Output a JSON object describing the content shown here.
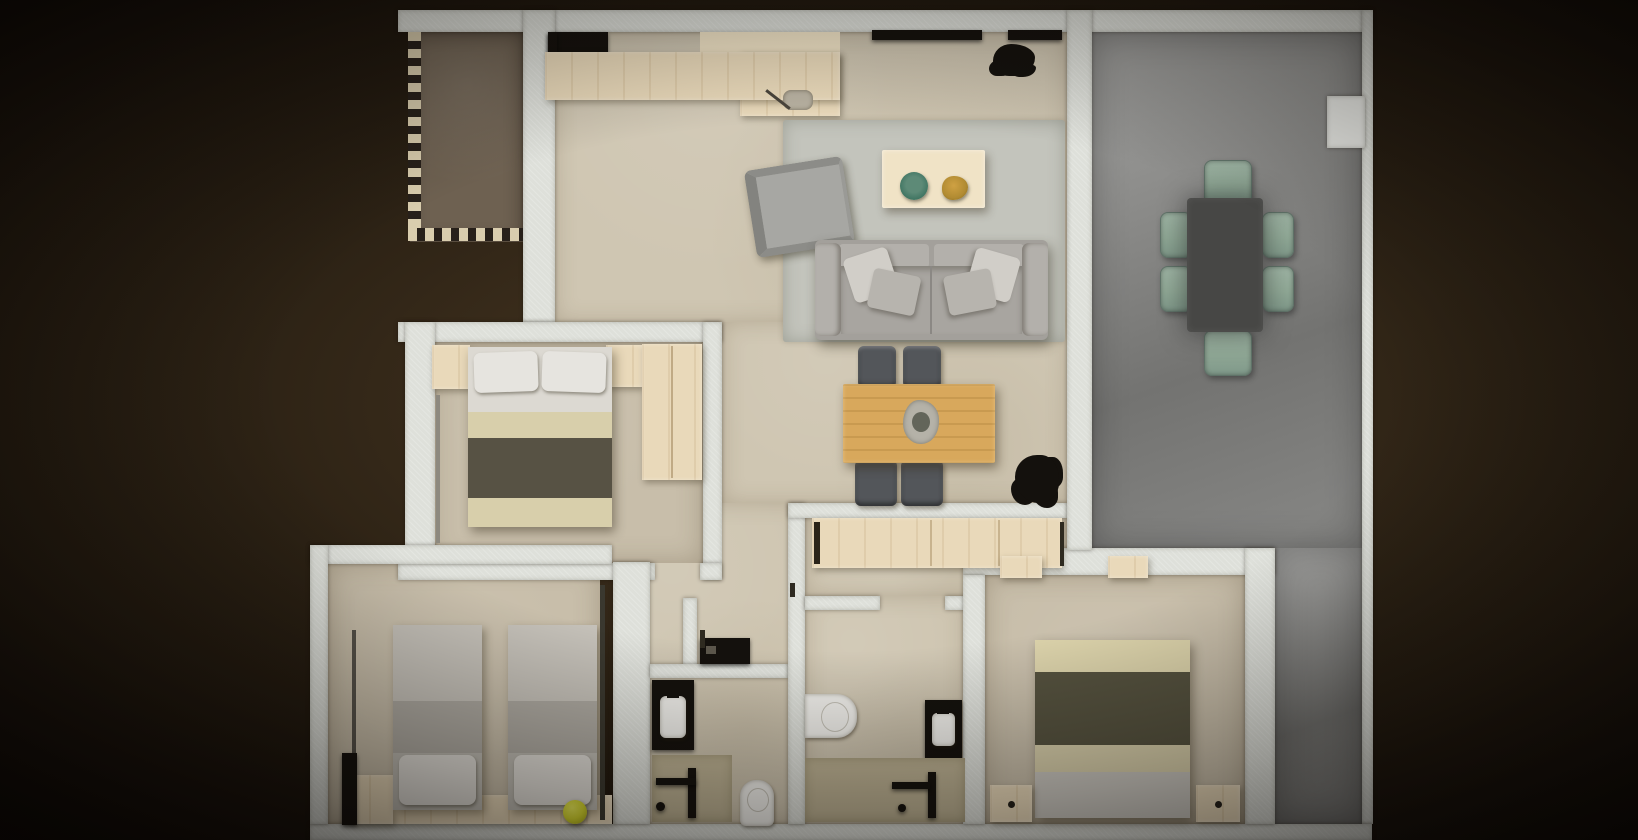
{
  "scene": {
    "type": "3d-floor-plan-render",
    "description": "Top-down 3D architectural render of an apartment floor plan, centered on a dark brown vignetted backdrop. No text labels are present in the image.",
    "rooms": [
      {
        "name": "balcony",
        "position": "top-left",
        "features": [
          "taupe-tile-floor",
          "dashed-railing-left",
          "dashed-railing-bottom"
        ]
      },
      {
        "name": "kitchen-living-room",
        "position": "top-center",
        "features": [
          "kitchen-counter",
          "black-cooktop",
          "window-slits",
          "area-rug",
          "armchair",
          "three-seat-sofa",
          "coffee-table",
          "green-plate",
          "gold-bowl",
          "black-plant"
        ]
      },
      {
        "name": "terrace",
        "position": "right",
        "features": [
          "gray-concrete-floor",
          "dark-dining-table",
          "six-sage-chairs",
          "wall-column"
        ]
      },
      {
        "name": "hall-dining",
        "position": "center",
        "features": [
          "oak-dining-table",
          "four-dark-chairs",
          "centerpiece",
          "black-plant",
          "wood-sideboard"
        ]
      },
      {
        "name": "bedroom-1",
        "position": "middle-left",
        "features": [
          "double-bed",
          "two-pillows",
          "olive-blanket",
          "two-nightstands",
          "wardrobe"
        ]
      },
      {
        "name": "bedroom-2",
        "position": "bottom-left",
        "features": [
          "twin-bed",
          "twin-bed",
          "wood-headboard-shelf",
          "yellow-ball",
          "dark-side-bar"
        ]
      },
      {
        "name": "bathroom-1",
        "position": "bottom-center-left",
        "features": [
          "washer-niche",
          "dark-vanity-with-white-sink",
          "shower-area",
          "shower-fixture",
          "toilet"
        ]
      },
      {
        "name": "bathroom-2",
        "position": "bottom-center-right",
        "features": [
          "wall-hung-toilet",
          "dark-vanity-with-white-sink",
          "shower-area",
          "shower-fixture"
        ]
      },
      {
        "name": "bedroom-3",
        "position": "bottom-right",
        "features": [
          "double-bed",
          "olive-blanket",
          "two-nightstands",
          "door-side-blocks"
        ]
      }
    ],
    "counts": {
      "bedrooms": 3,
      "bathrooms": 2,
      "terrace_dining_chairs": 6,
      "hall_dining_chairs": 4
    }
  },
  "palette": {
    "background_dark": "#0a0604",
    "background_mid": "#2b2114",
    "background_light": "#4c3a24",
    "wall": "#dee0da",
    "wall_bright": "#e9eae6",
    "floor_main": "#cfc6b2",
    "floor_bedroom": "#c8beaa",
    "floor_balcony": "#6e6151",
    "floor_shower": "#bcb193",
    "terrace_light": "#a2a2a0",
    "terrace_dark": "#737371",
    "rug": "#c3c4bc",
    "wood_light": "#e9d9ba",
    "wood_pale": "#f0e3c6",
    "oak": "#d8a85c",
    "sofa_base": "#a3a09b",
    "sofa_light": "#b3b0ab",
    "pillow_light": "#d1cec8",
    "chair_dark": "#53565a",
    "chair_sage": "#8fa795",
    "table_dark": "#474745",
    "blanket_olive": "#575244",
    "cream_bed": "#d8cfab",
    "sheet_white": "#dcd9d2",
    "bed_gray_light": "#c5c1b9",
    "bed_gray_mid": "#aeaaa2",
    "white_fixture": "#efeeea",
    "black_item": "#14110d",
    "ball_yellow": "#d9da2f",
    "plate_green": "#417663",
    "gold": "#b18b32",
    "checker_cream": "#d9cdae",
    "checker_dark": "#27201a"
  }
}
